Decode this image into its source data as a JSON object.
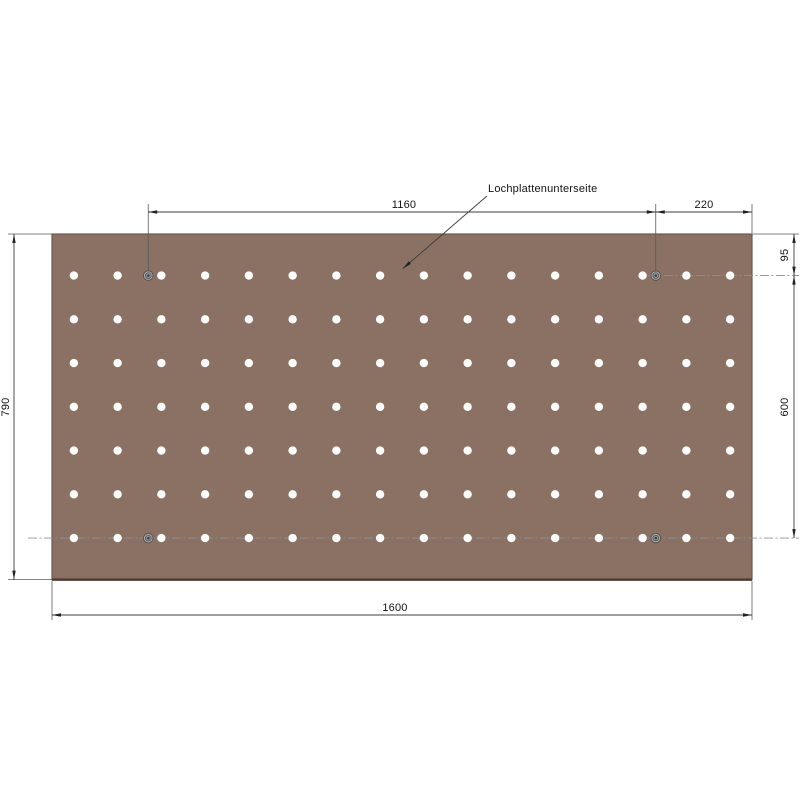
{
  "callout": {
    "label": "Lochplattenunterseite"
  },
  "dimensions": {
    "screw_span_horizontal": "1160",
    "screw_to_right_edge": "220",
    "top_to_first_row": "95",
    "first_to_last_row": "600",
    "plate_height": "790",
    "plate_width": "1600"
  },
  "plate": {
    "width_mm": 1600,
    "height_mm": 790,
    "color": "#8a7164",
    "edge_color": "#6e594b",
    "bottom_shadow_color": "#4d3d33",
    "hole_color": "#ffffff",
    "grid": {
      "columns": 16,
      "rows": 7,
      "pitch_mm": 100,
      "side_margin_mm": 50,
      "first_row_from_top_mm": 95
    },
    "screw_holes": {
      "count": 4,
      "inset_from_sides_mm": 220,
      "rows_from_top_mm": [
        95,
        695
      ],
      "ring_color": "#a9a9a9",
      "ring_edge_color": "#4f4f4f",
      "inner_ring_color": "#8f8f8f",
      "center_color": "#3d3d3d"
    }
  },
  "colors": {
    "background": "#ffffff",
    "dimension_line": "#3c3c3c",
    "centerline": "#8f8f8f",
    "text": "#141414"
  }
}
